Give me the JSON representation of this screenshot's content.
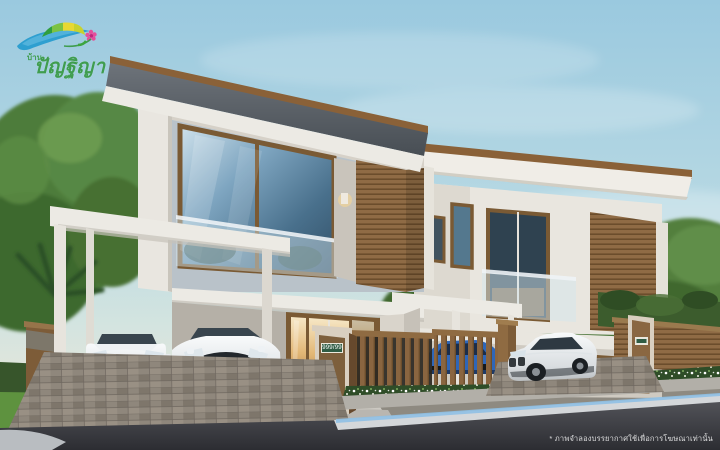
{
  "brand": {
    "prefix": "บ้าน",
    "name": "ปัญฐิญา"
  },
  "house_sign": {
    "number": "999/99"
  },
  "footer": {
    "disclaimer": "* ภาพจำลองบรรยากาศใช้เพื่อการโฆษณาเท่านั้น"
  },
  "palette": {
    "sky_top": "#9BCADF",
    "sky_horizon": "#E7E5D8",
    "wall_white": "#ECEAE4",
    "wood": "#8A6742",
    "wood_dark": "#6B4D2C",
    "roof_dark": "#51575D",
    "glass_blue": "#49708C",
    "warm_light": "#E3B877",
    "foliage_green": "#4D7C3A",
    "hedge_green": "#37552B",
    "grass_green": "#5E923F",
    "road_dark": "#35363B",
    "curb_glow": "#8FC0E4",
    "sign_green": "#2F5C44",
    "car_blue": "#2F66B8",
    "logo_blue": "#2E9FD0",
    "logo_green": "#3DA53F",
    "logo_yellow": "#E8D832",
    "logo_pink": "#E54F9B",
    "logo_text_green": "#3F9D4F"
  }
}
